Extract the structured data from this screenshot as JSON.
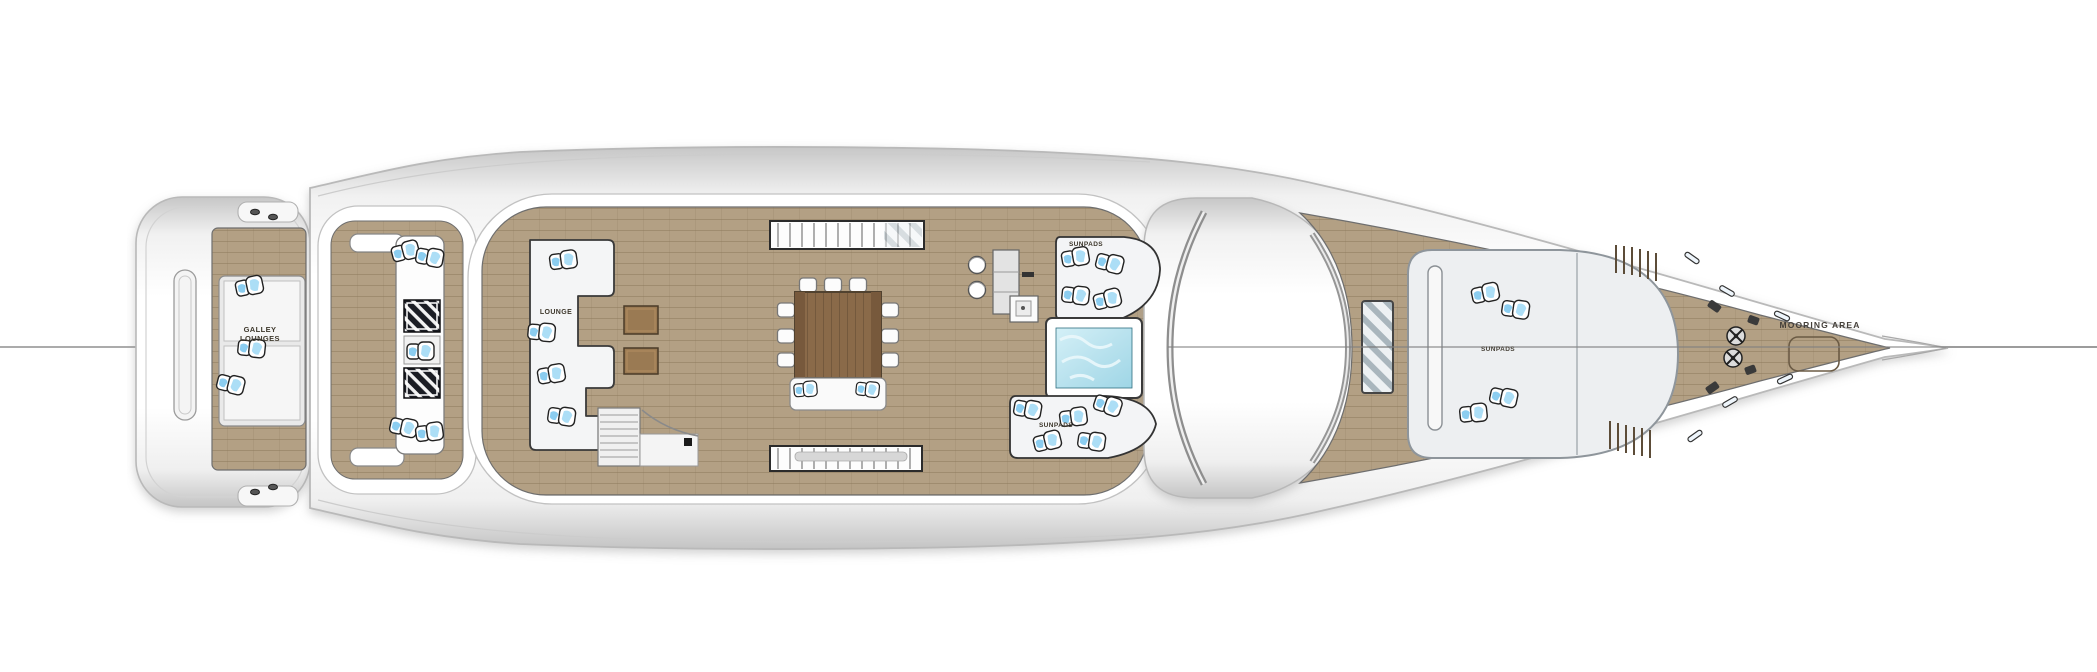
{
  "diagram": {
    "type": "yacht-deck-plan-top-view",
    "labels": {
      "stern_lounge_line1": "GALLEY",
      "stern_lounge_line2": "LOUNGES",
      "port_lounge": "LOUNGE",
      "aft_sunpad_top": "SUNPADS",
      "aft_sunpad_bottom": "SUNPADS",
      "foredeck_sunpad": "SUNPADS",
      "bow_area": "MOORING AREA"
    },
    "features": [
      "swim platform",
      "transom step plates with cleats",
      "stern lounge with cushions",
      "corner sofas",
      "two striped side tables",
      "port lounge sofa",
      "two teak deck hatches",
      "dining table with chairs",
      "aft bench with cushions",
      "two skylights",
      "staircase to lower deck",
      "bar with two stools",
      "grill and sink unit",
      "port sunpad",
      "starboard sunpad",
      "jacuzzi",
      "superstructure roof",
      "foredeck double sunpad",
      "glass deck hatch",
      "two mooring winches",
      "cleats",
      "anchor locker hatch",
      "pointed bow with centerline"
    ],
    "colors": {
      "deck_wood": "#b3a084",
      "plank_line": "#8b7759",
      "hull_white": "#ffffff",
      "hull_edge": "#bdbdbd",
      "table_wood": "#8a6a49",
      "dark_table": "#1b1d24",
      "jacuzzi_water": "#b9e2ee",
      "cushion_blue": "#7ec8ee",
      "label_text": "#3e382c",
      "centerline": "#8f8f8f"
    }
  }
}
